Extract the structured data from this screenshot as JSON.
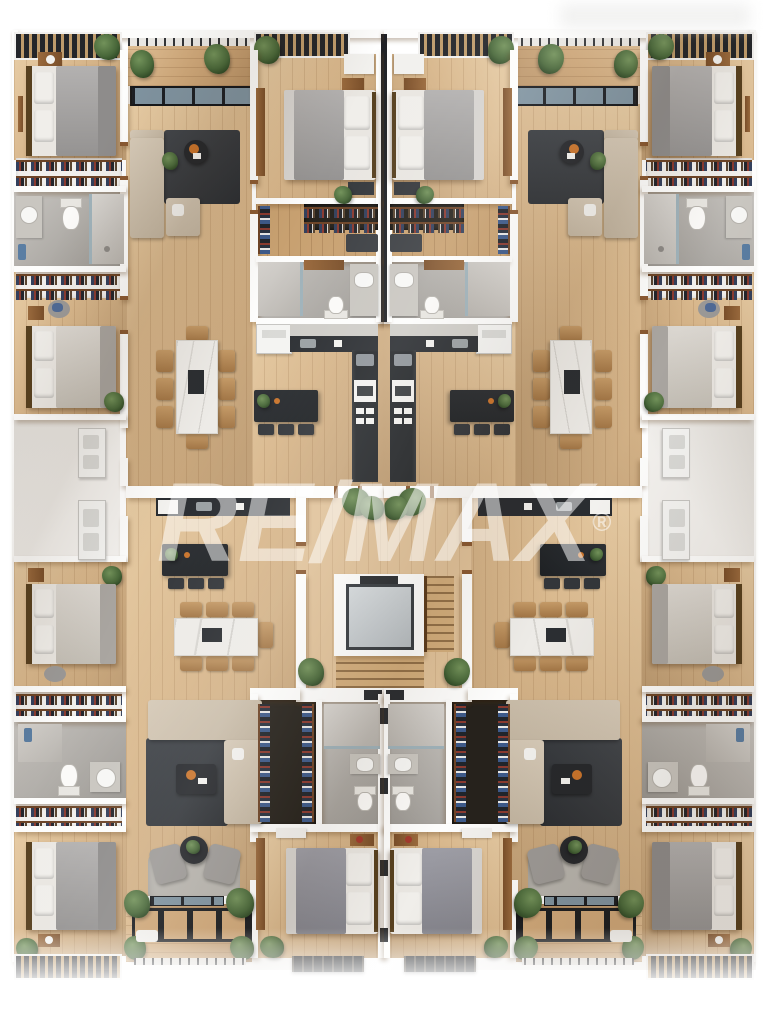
{
  "image": {
    "kind": "3d-top-down-floor-plan-rendering",
    "watermark": {
      "text": "RE/MAX",
      "registered": "®"
    }
  },
  "building": {
    "units_visible": 4,
    "layout_symmetry": "left-right mirrored, four apartments around a central core",
    "core": [
      "elevator",
      "staircase",
      "hallway with potted plants"
    ],
    "unit_features": {
      "bedrooms": 3,
      "bathrooms": 2,
      "rooms": [
        "living room with l-shaped sofa",
        "open kitchen with island and bar stools",
        "dining area with marble table",
        "walk-in closet",
        "balconies with pergola slats",
        "laundry appliance niche"
      ]
    }
  },
  "palette": {
    "wall": "#fdfdfc",
    "wood_floor": "#d8b78c",
    "wood_floor_dark": "#c8a171",
    "balcony_deck": "#cfa87a",
    "dark_fixture": "#26292c",
    "rug_charcoal": "#36393d",
    "rug_light": "#b7b4ae",
    "sofa_beige": "#cdc1af",
    "bed_gray": "#a6a4a3",
    "bed_cream": "#d8d4ce",
    "bathroom_tile": "#b3afa9",
    "wood_accent": "#8a5a33",
    "chair_tan": "#b98e5f",
    "plant_green": "#49683a",
    "elevator_car": "#c9ced1",
    "elevator_frame": "#383d42",
    "glass": "#7f93a0",
    "watermark_color": "rgba(255,255,255,0.52)"
  }
}
